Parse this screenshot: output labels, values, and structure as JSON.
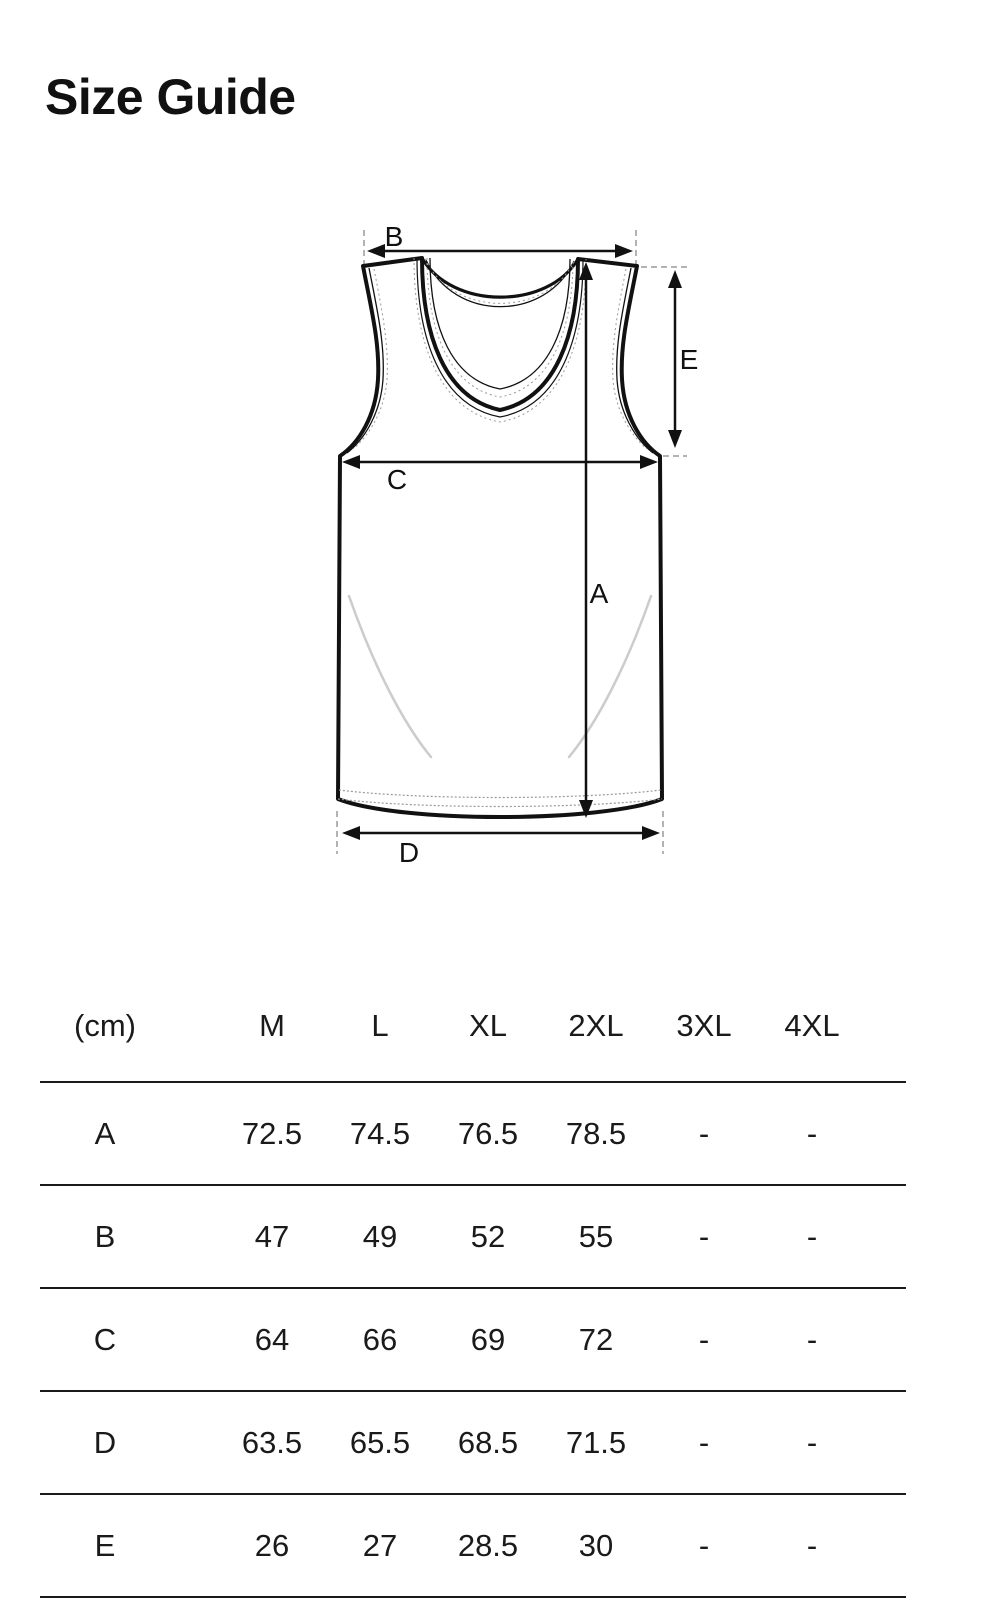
{
  "page": {
    "title": "Size Guide"
  },
  "diagram": {
    "labels": {
      "a": "A",
      "b": "B",
      "c": "C",
      "d": "D",
      "e": "E"
    }
  },
  "table": {
    "unit_header": "(cm)",
    "size_headers": [
      "M",
      "L",
      "XL",
      "2XL",
      "3XL",
      "4XL"
    ],
    "rows": [
      {
        "label": "A",
        "values": [
          "72.5",
          "74.5",
          "76.5",
          "78.5",
          "-",
          "-"
        ]
      },
      {
        "label": "B",
        "values": [
          "47",
          "49",
          "52",
          "55",
          "-",
          "-"
        ]
      },
      {
        "label": "C",
        "values": [
          "64",
          "66",
          "69",
          "72",
          "-",
          "-"
        ]
      },
      {
        "label": "D",
        "values": [
          "63.5",
          "65.5",
          "68.5",
          "71.5",
          "-",
          "-"
        ]
      },
      {
        "label": "E",
        "values": [
          "26",
          "27",
          "28.5",
          "30",
          "-",
          "-"
        ]
      }
    ]
  },
  "colors": {
    "background": "#ffffff",
    "line": "#111111",
    "text": "#1a1a1a",
    "stitch": "#999999",
    "guide": "#b3b3b3",
    "drape": "#cccccc"
  }
}
